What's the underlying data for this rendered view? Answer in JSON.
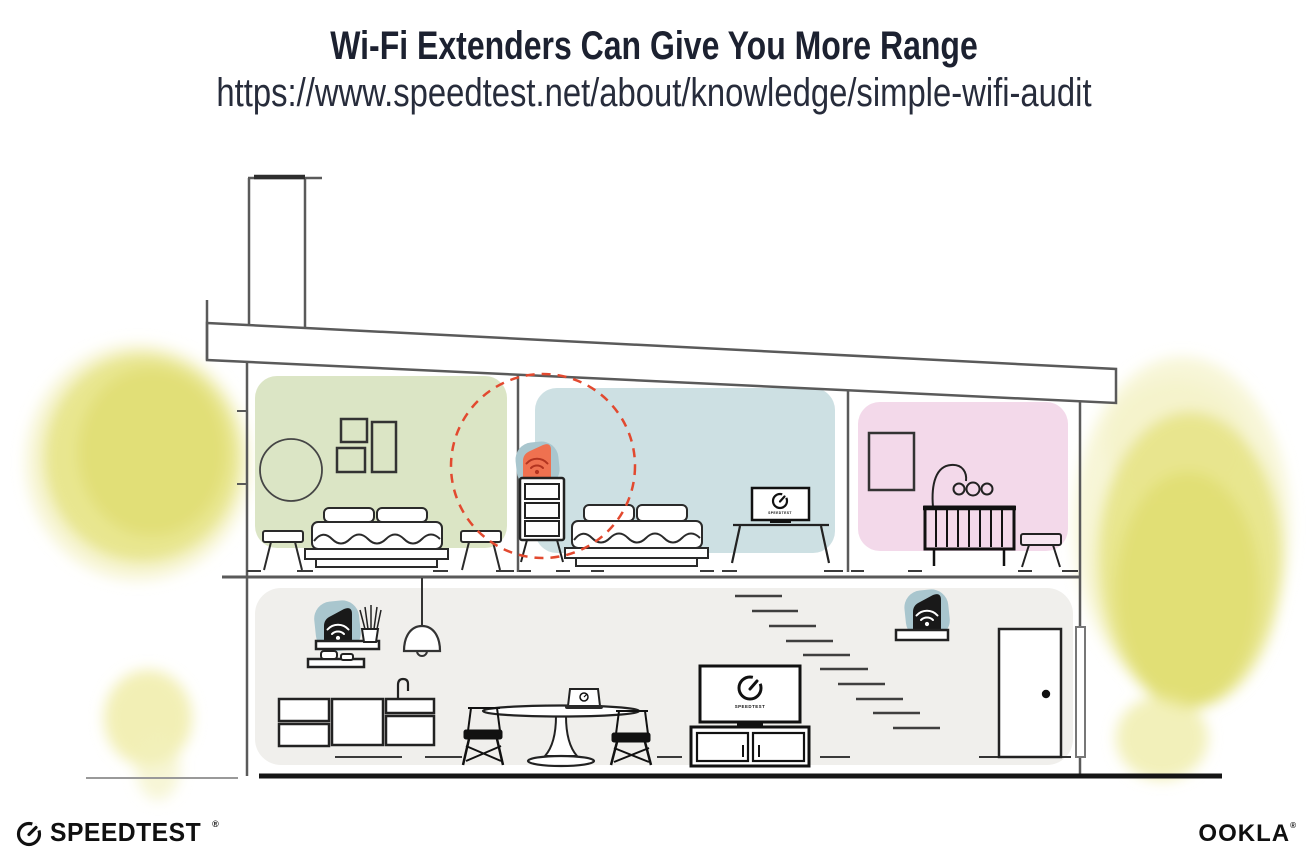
{
  "header": {
    "title": "Wi-Fi Extenders Can Give You More Range",
    "url": "https://www.speedtest.net/about/knowledge/simple-wifi-audit"
  },
  "illustration": {
    "screen_label": "SPEEDTEST",
    "colors": {
      "green_room": "#dbe5c5",
      "blue_room": "#cde0e3",
      "pink_room": "#f3d9ea",
      "ground_floor": "#f0efec",
      "foliage_yellow": "#e5e282",
      "extender_orange": "#ef7150",
      "extender_halo_blue": "#a9c6ce",
      "range_circle_red": "#e2492f",
      "device_black": "#191919",
      "line_gray": "#5a5a5a"
    }
  },
  "footer": {
    "speedtest_wordmark": "SPEEDTEST",
    "speedtest_trademark": "®",
    "ookla_wordmark": "OOKLA",
    "ookla_trademark": "®"
  }
}
